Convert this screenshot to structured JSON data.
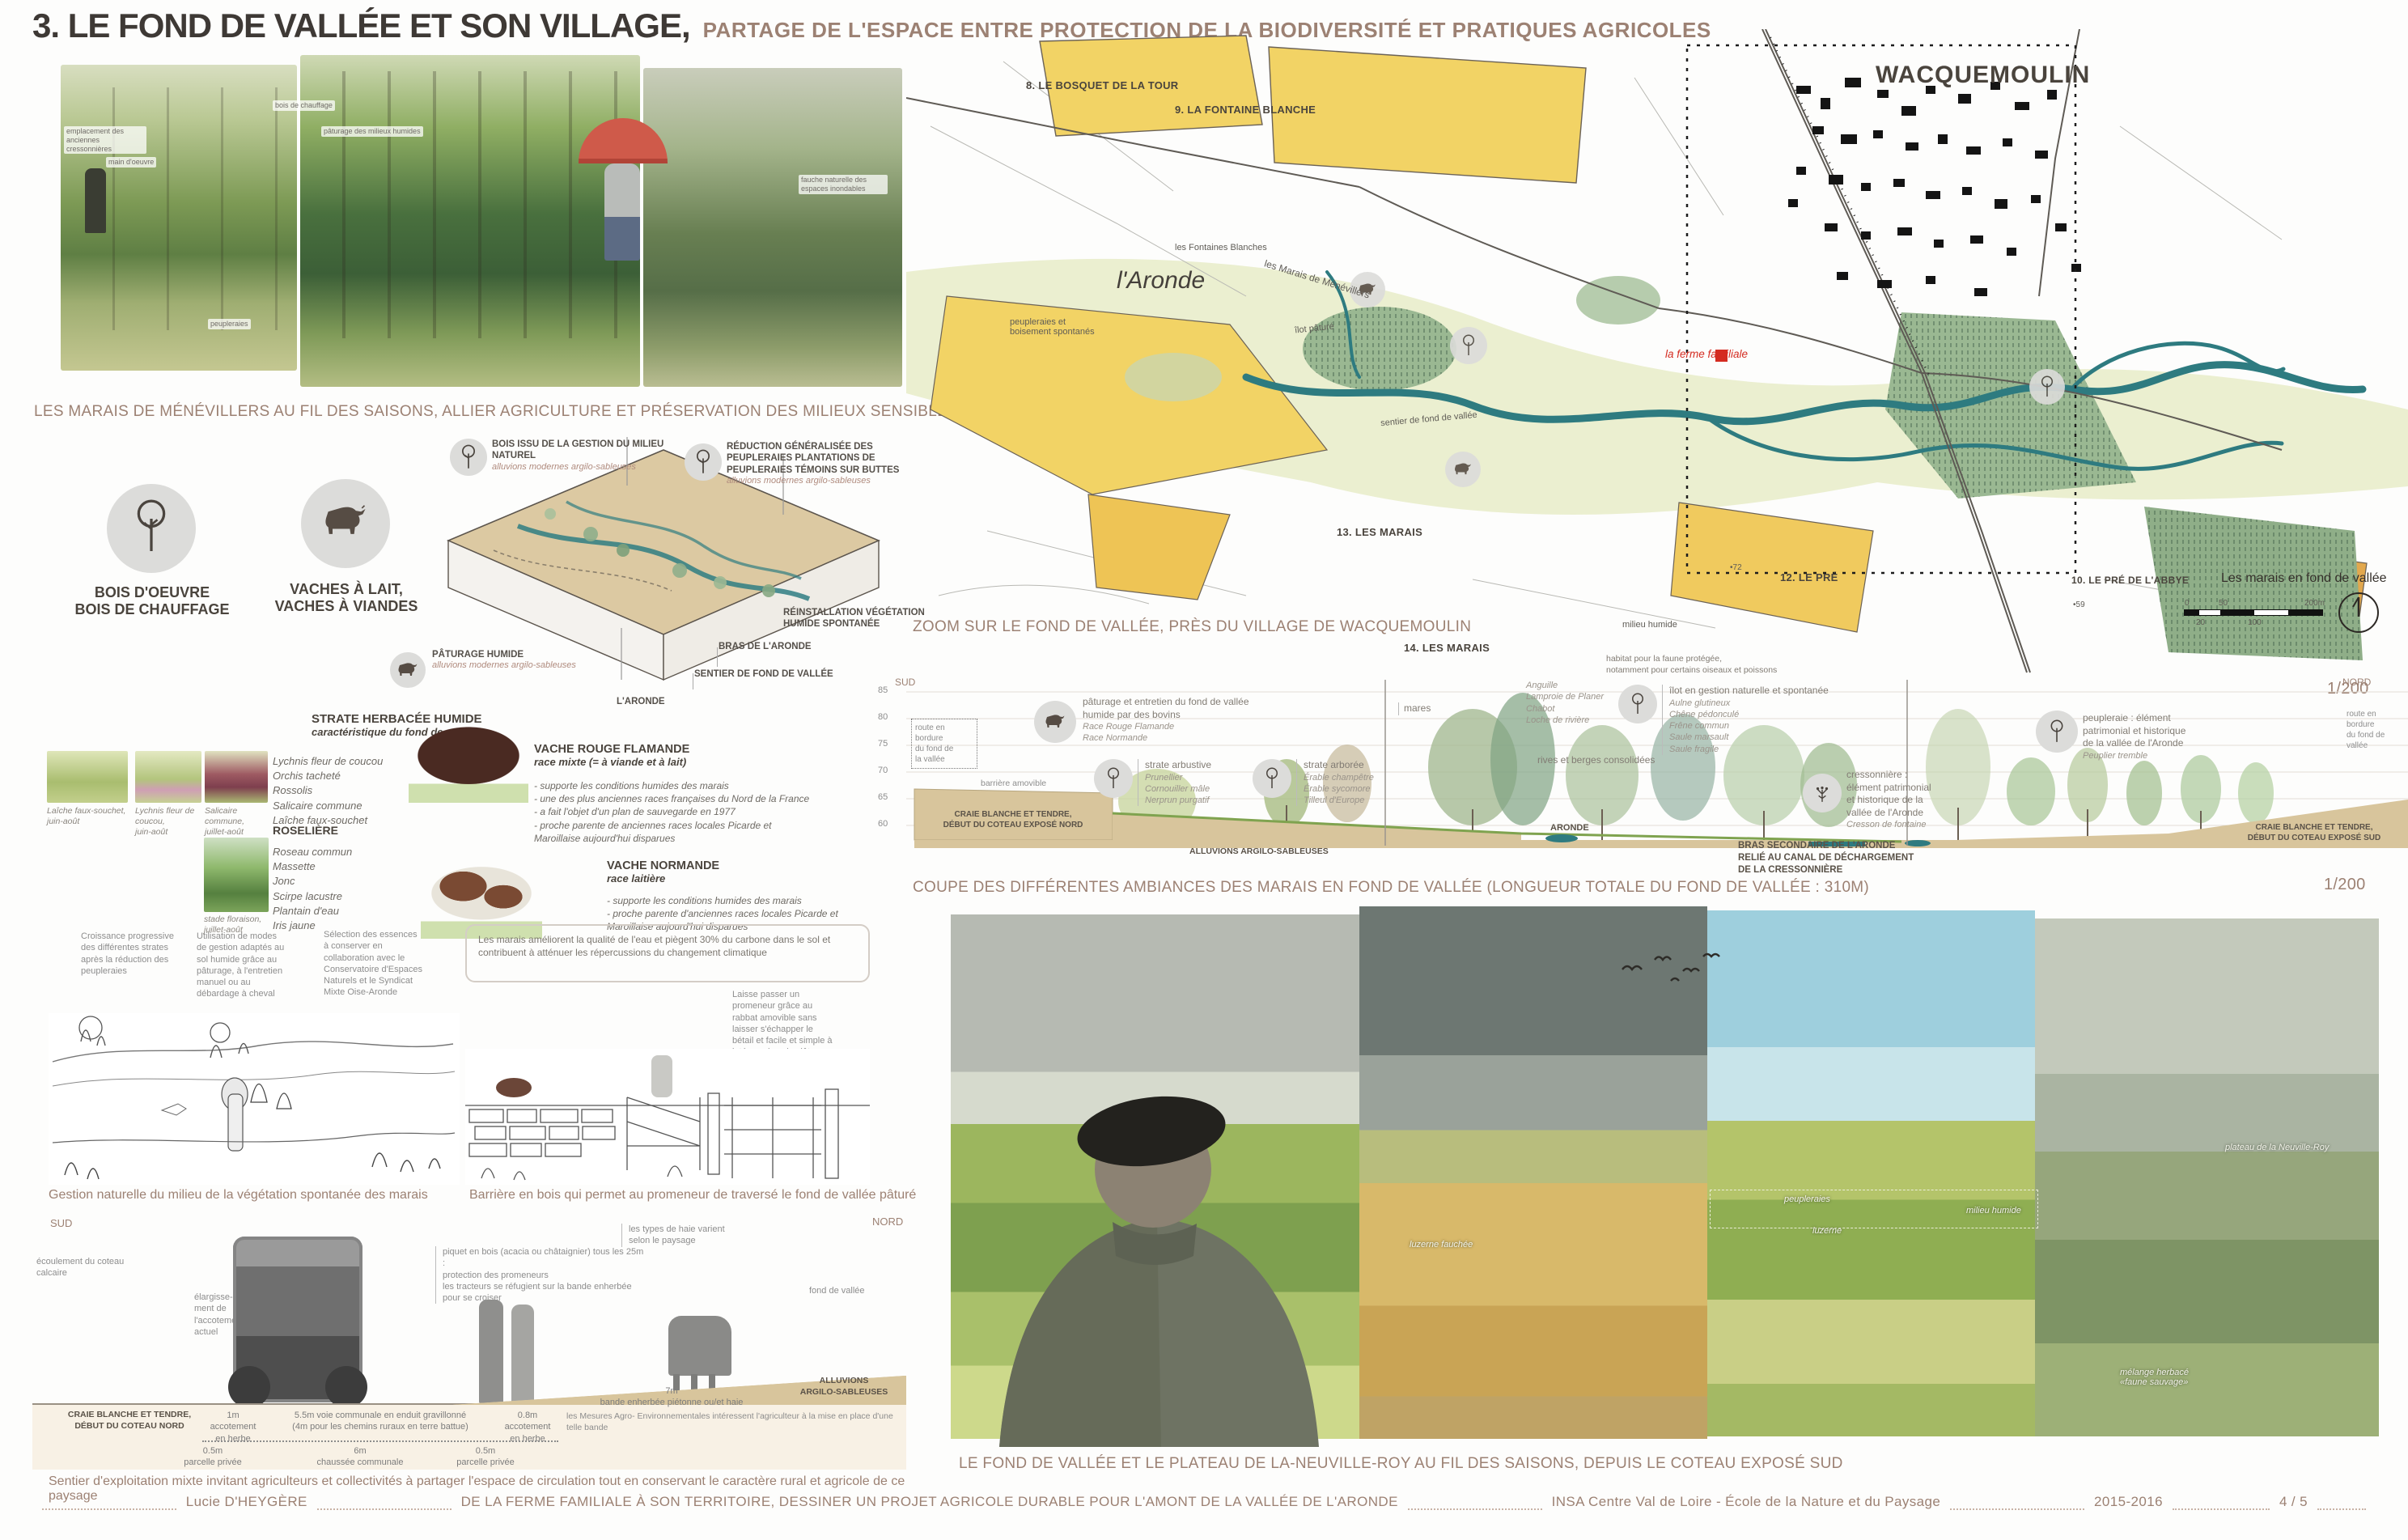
{
  "colors": {
    "caption": "#9c8173",
    "ink": "#45403b",
    "map_yellow": "#f2d365",
    "map_orange": "#e2a84e",
    "valley_green": "#e9edcb",
    "wood_green": "#93ad8c",
    "river_teal": "#2f7e82",
    "ground_tan": "#d8c59c",
    "ferme_red": "#d42b20"
  },
  "header": {
    "title": "3. LE FOND DE VALLÉE ET SON VILLAGE,",
    "subtitle": "PARTAGE DE L'ESPACE ENTRE PROTECTION DE LA BIODIVERSITÉ ET PRATIQUES AGRICOLES"
  },
  "seasons": {
    "caption": "LES MARAIS DE MÉNÉVILLERS AU FIL DES SAISONS, ALLIER AGRICULTURE ET PRÉSERVATION DES MILIEUX SENSIBLES",
    "labels": {
      "l1": "emplacement des anciennes cressonnières",
      "l2": "main d'oeuvre",
      "l3": "bois de chauffage",
      "l4": "pâturage des milieux humides",
      "l5": "peupleraies",
      "l6": "fauche naturelle des espaces inondables"
    }
  },
  "resources": {
    "wood": "BOIS D'OEUVRE\nBOIS DE CHAUFFAGE",
    "cows": "VACHES À LAIT,\nVACHES À VIANDES"
  },
  "axon": {
    "a_bois": {
      "title": "BOIS ISSU DE LA GESTION DU MILIEU NATUREL",
      "sub": "alluvions modernes argilo-sableuses"
    },
    "a_reduction": {
      "title": "RÉDUCTION GÉNÉRALISÉE DES PEUPLERAIES PLANTATIONS DE PEUPLERAIES TÉMOINS SUR BUTTES",
      "sub": "alluvions modernes argilo-sableuses"
    },
    "a_reinstallation": "RÉINSTALLATION VÉGÉTATION\nHUMIDE SPONTANÉE",
    "a_bras": "BRAS DE L'ARONDE",
    "a_sentier": "SENTIER DE FOND DE VALLÉE",
    "a_aronde": "L'ARONDE",
    "a_paturage": {
      "title": "PÂTURAGE HUMIDE",
      "sub": "alluvions modernes argilo-sableuses"
    }
  },
  "flora": {
    "heading": "STRATE HERBACÉE HUMIDE",
    "subheading": "caractéristique du fond de vallée",
    "thumbs": [
      "Laîche faux-souchet,\njuin-août",
      "Lychnis fleur de coucou,\njuin-août",
      "Salicaire commune,\njuillet-août",
      "stade floraison,\njuillet-août"
    ],
    "herbacee_species": [
      "Lychnis fleur de coucou",
      "Orchis tacheté",
      "Rossolis",
      "Salicaire commune",
      "Laîche faux-souchet"
    ],
    "roseliere_heading": "ROSELIÈRE",
    "roseliere_species": [
      "Roseau commun",
      "Massette",
      "Jonc",
      "Scirpe lacustre",
      "Plantain d'eau",
      "Iris jaune"
    ]
  },
  "cattle": {
    "flamande": {
      "name": "VACHE ROUGE FLAMANDE",
      "type": "race mixte (= à viande et à lait)",
      "notes": [
        "- supporte les conditions humides des marais",
        "- une des plus anciennes races françaises du Nord de la France",
        "- a fait l'objet d'un plan de sauvegarde en 1977",
        "- proche parente de anciennes races locales Picarde et",
        "Maroillaise aujourd'hui disparues"
      ]
    },
    "normande": {
      "name": "VACHE NORMANDE",
      "type": "race laitière",
      "notes": [
        "- supporte les conditions humides des marais",
        "- proche parente d'anciennes races locales Picarde et",
        "Maroillaise aujourd'hui disparues"
      ]
    }
  },
  "sketches": {
    "note_croissance": "Croissance progressive\ndes différentes strates\naprès la réduction des\npeupleraies",
    "note_gestion": "Utilisation de  modes\nde gestion adaptés au\nsol humide grâce au\npâturage, à l'entretien\nmanuel ou au\ndébardage à cheval",
    "note_selection": "Sélection des essences\nà conserver en\ncollaboration avec le\nConservatoire d'Espaces\nNaturels et le Syndicat\nMixte Oise-Aronde",
    "note_marais_box": "Les marais améliorent la qualité de l'eau et piègent 30% du carbone dans le sol et contribuent à atténuer les répercussions du changement climatique",
    "note_barriere": "Laisse passer un\npromeneur grâce au\nrabbat amovible sans\nlaisser s'échapper le\nbétail et facile et simple à\nintégrer dans la clôture",
    "caption_left": "Gestion naturelle du milieu de la végétation spontanée des marais",
    "caption_right": "Barrière en bois qui permet au promeneur de traversé le fond de vallée pâturé"
  },
  "road": {
    "sud": "SUD",
    "nord": "NORD",
    "note_ecoulement": "écoulement du coteau calcaire",
    "note_elargissement": "élargisse-\nment de\nl'accotement\nactuel",
    "note_piquet": "piquet en bois (acacia ou châtaignier) tous les 25m :\nprotection des promeneurs\nles tracteurs se réfugient sur la bande enherbée  pour se croiser",
    "note_haie": "les types de haie varient\nselon le paysage",
    "note_fond": "fond de vallée",
    "craie": "CRAIE BLANCHE ET TENDRE,\nDÉBUT DU COTEAU NORD",
    "alluvions": "ALLUVIONS\nARGILO-SABLEUSES",
    "dim_1m": "1m\naccotement\nen herbe",
    "dim_55": "5.5m voie communale en enduit gravillonné\n(4m pour les chemins ruraux en terre battue)",
    "dim_08": "0.8m\naccotement\nen herbe",
    "dim_7m": "7m\nbande enherbée piétonne ou/et haie",
    "note_mae": "les Mesures Agro- Environnementales intéressent l'agriculteur à la mise en place d'une telle bande",
    "dim_05a": "0.5m\nparcelle privée",
    "dim_6m": "6m\nchaussée communale",
    "dim_05b": "0.5m\nparcelle privée",
    "caption": "Sentier d'exploitation mixte invitant agriculteurs et collectivités à partager l'espace de circulation tout en conservant le caractère rural et agricole de ce paysage"
  },
  "map": {
    "village": "WACQUEMOULIN",
    "p8": "8. LE BOSQUET DE LA TOUR",
    "p9": "9. LA FONTAINE BLANCHE",
    "p13": "13. LES MARAIS",
    "p14": "14. LES MARAIS",
    "p12": "12. LE PRÉ",
    "p10": "10. LE PRÉ DE L'ABBYE",
    "fontaines": "les Fontaines Blanches",
    "marais_menevillers": "les Marais de Ménévillers",
    "peupleraies": "peupleraies et\nboisement spontanés",
    "ilot": "îlot pâturé",
    "sentier": "sentier de fond de vallée",
    "milieu": "milieu humide",
    "ferme": "la ferme familiale",
    "aronde": "l'Aronde",
    "pt72": "72",
    "pt59": "59",
    "legend_title": "Les marais en fond de vallée",
    "scale_ticks": [
      "0",
      "20",
      "50",
      "100",
      "200m"
    ],
    "caption": "ZOOM SUR LE FOND DE VALLÉE, PRÈS DU VILLAGE DE WACQUEMOULIN",
    "scale_note": "1/200"
  },
  "coupe": {
    "sud": "SUD",
    "nord": "NORD",
    "elev_ticks": [
      "85",
      "80",
      "75",
      "70",
      "65",
      "60"
    ],
    "paturage_title": "pâturage et entretien du fond de vallée\nhumide par des bovins",
    "paturage_species": "Race Rouge Flamande\nRace Normande",
    "route_left": "route en\nbordure\ndu fond de\nla vallée",
    "barriere": "barrière amovible",
    "arbustive_title": "strate arbustive",
    "arbustive_species": "Prunellier\nCornouiller mâle\nNerprun purgatif",
    "arboree_title": "strate arborée",
    "arboree_species": "Érable champêtre\nÉrable sycomore\nTilleul d'Europe",
    "mares": "mares",
    "faune_title": "habitat pour la faune protégée,\nnotamment pour certains oiseaux et poissons",
    "faune_species": "Anguille\nLamproie de Planer\nChabot\nLoche de rivière",
    "rives": "rives et berges consolidées",
    "aronde_label": "ARONDE",
    "ilot_title": "îlot en gestion naturelle et spontanée",
    "ilot_species": "Aulne glutineux\nChêne pédonculé\nFrêne commun\nSaule marsault\nSaule fragile",
    "cress_title": "cressonnière :\nélément patrimonial\net historique de la\nvallée de l'Aronde",
    "cress_species": "Cresson de fontaine",
    "bras": "BRAS SECONDAIRE DE L'ARONDE\nRELIÉ AU CANAL DE DÉCHARGEMENT\nDE LA CRESSONNIÈRE",
    "peupleraie_title": "peupleraie : élément\npatrimonial et historique\nde la vallée de l'Aronde",
    "peupleraie_species": "Peuplier tremble",
    "route_right": "route en\nbordure\ndu fond de\nvallée",
    "craie_nord": "CRAIE BLANCHE ET TENDRE,\nDÉBUT DU COTEAU EXPOSÉ NORD",
    "alluvions": "ALLUVIONS ARGILO-SABLEUSES",
    "craie_sud": "CRAIE BLANCHE ET TENDRE,\nDÉBUT DU COTEAU EXPOSÉ SUD",
    "caption": "COUPE DES DIFFÉRENTES AMBIANCES DES MARAIS EN FOND DE VALLÉE (LONGUEUR TOTALE DU FOND DE VALLÉE : 310M)",
    "scale_note": "1/200"
  },
  "panorama": {
    "labels": {
      "plateau": "plateau de la Neuville-Roy",
      "peupleraies": "peupleraies",
      "milieu": "milieu humide",
      "luzerne": "luzerne",
      "luzerne_fauchee": "luzerne fauchée",
      "melange": "mélange herbacé\n«faune sauvage»"
    },
    "caption": "LE FOND DE VALLÉE ET LE PLATEAU DE LA-NEUVILLE-ROY AU FIL DES SAISONS, DEPUIS LE COTEAU EXPOSÉ SUD"
  },
  "footer": {
    "author": "Lucie D'HEYGÈRE",
    "project": "DE LA FERME FAMILIALE À SON TERRITOIRE, DESSINER UN PROJET AGRICOLE DURABLE POUR L'AMONT DE LA VALLÉE DE L'ARONDE",
    "school": "INSA Centre Val de Loire - École de la Nature et du Paysage",
    "year": "2015-2016",
    "page": "4 / 5"
  }
}
